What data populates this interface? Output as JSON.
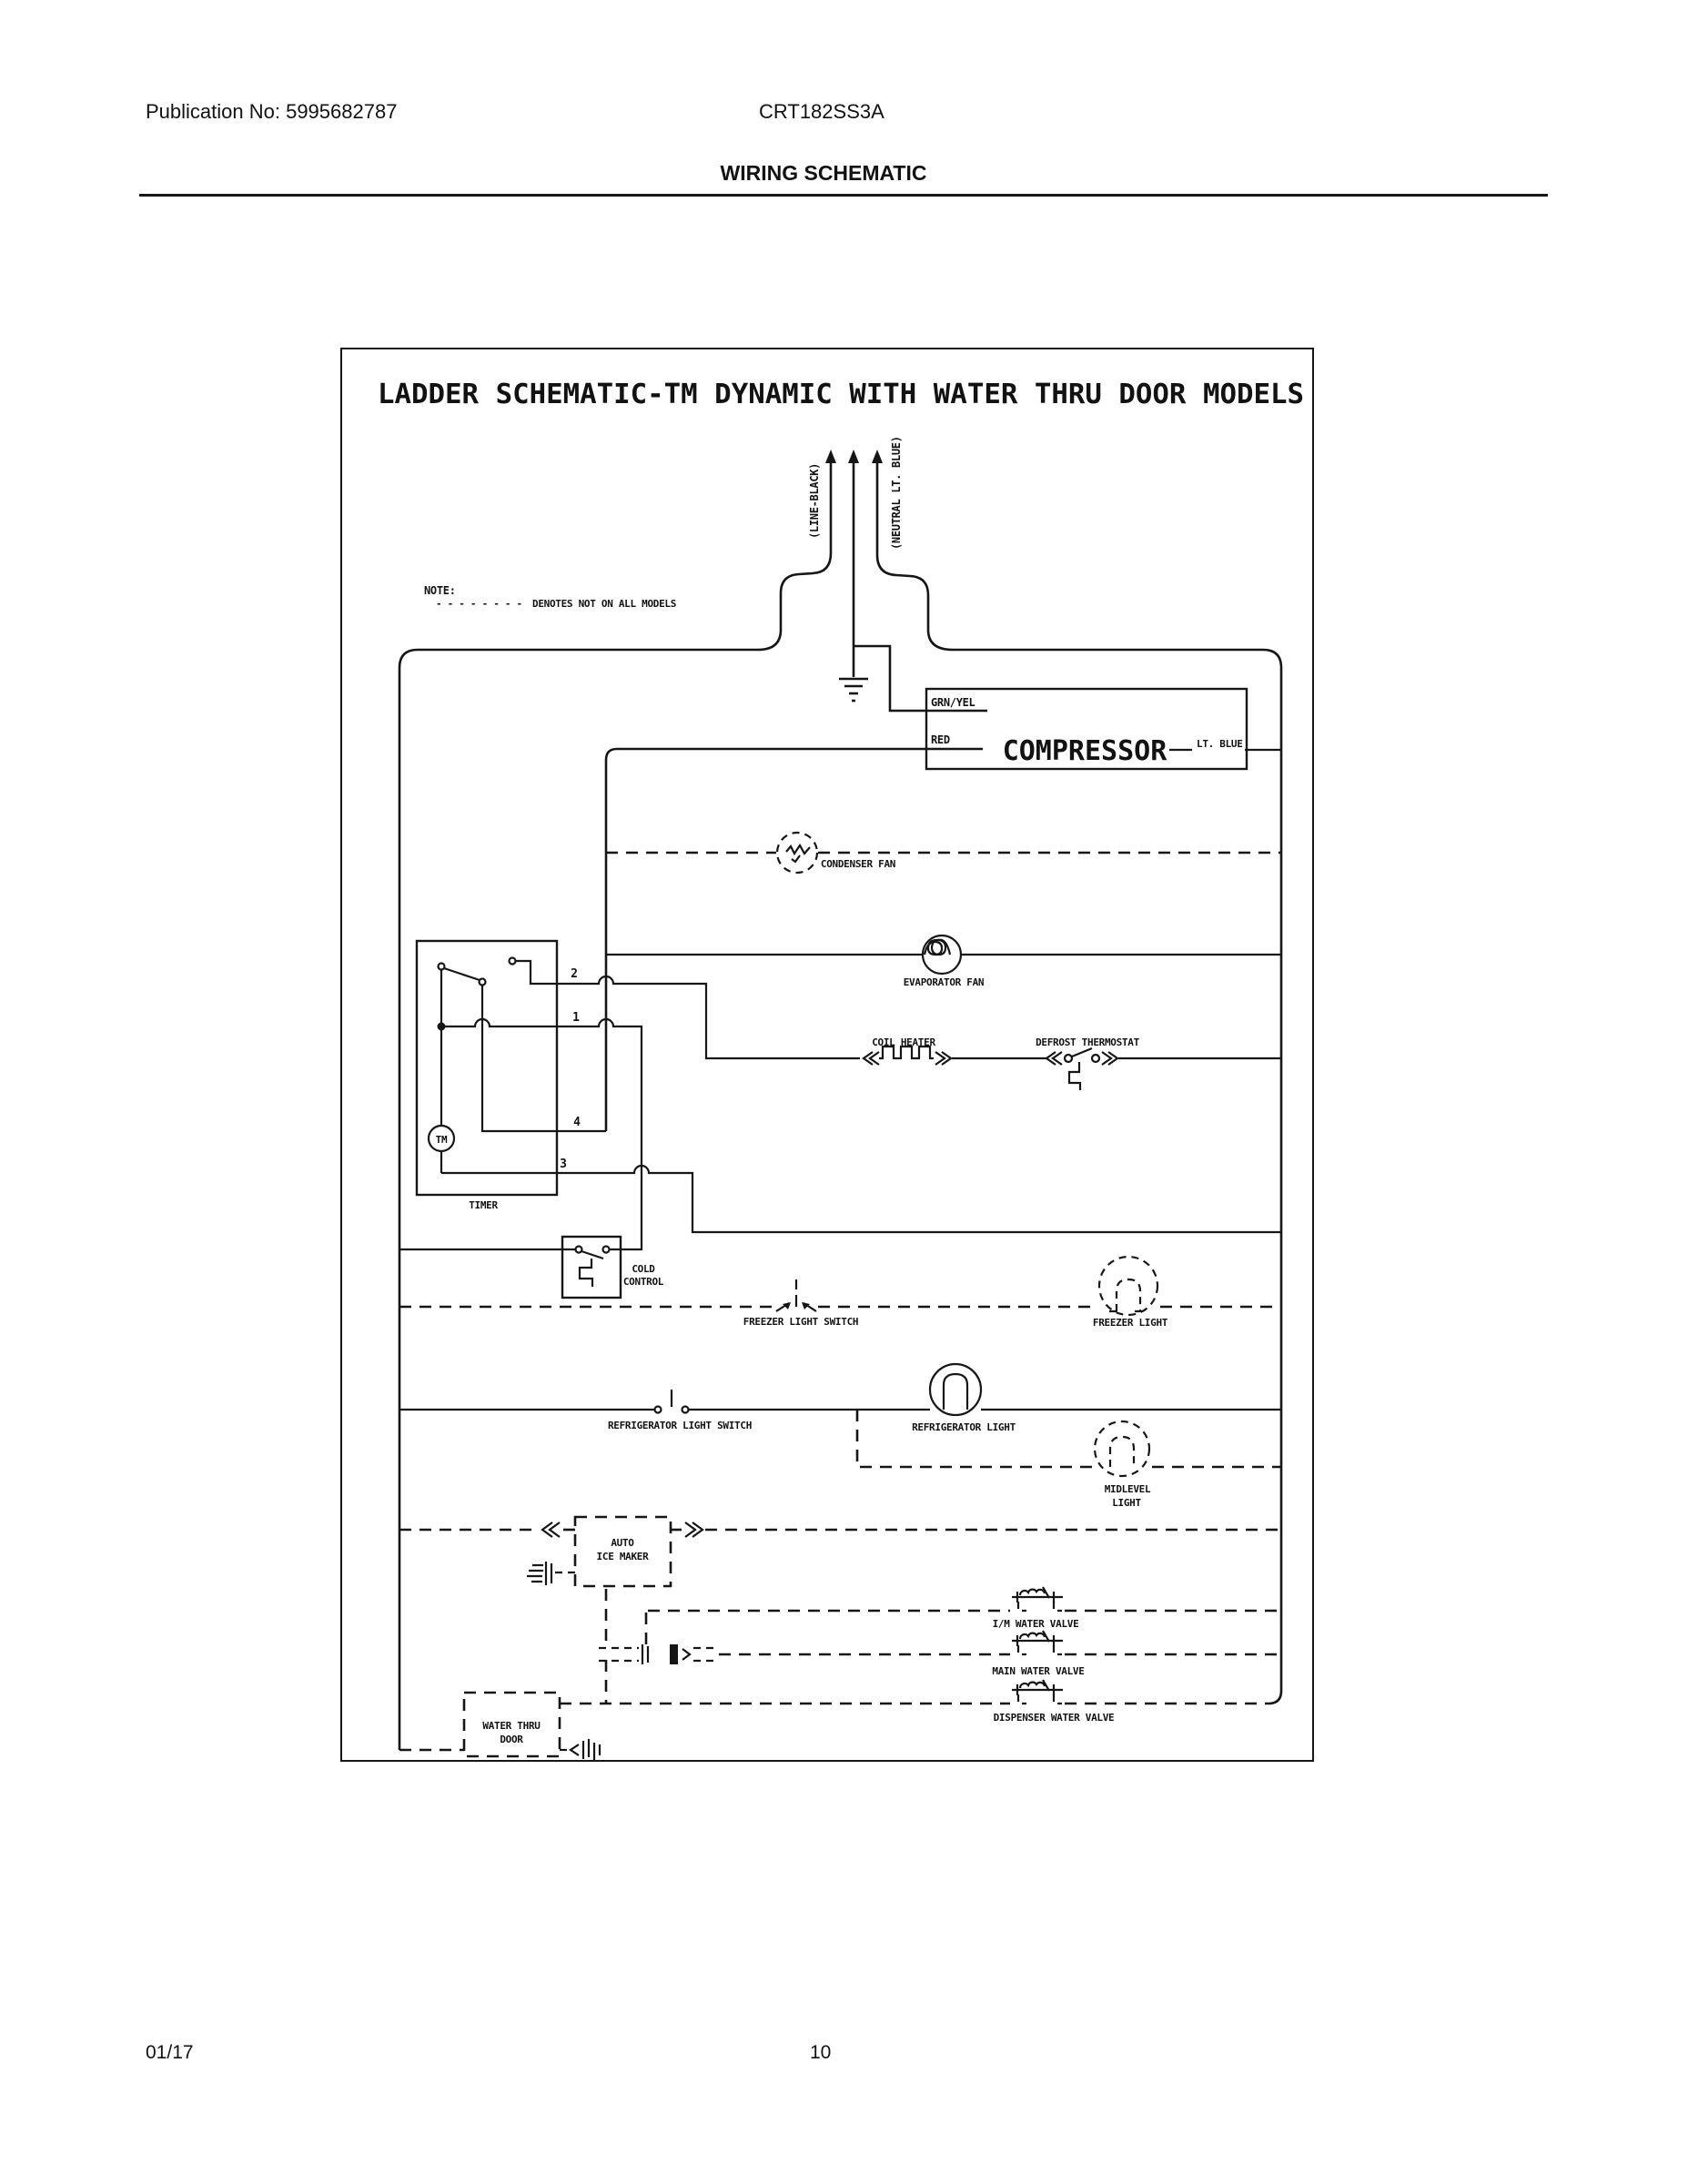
{
  "header": {
    "publication": "Publication No: 5995682787",
    "model": "CRT182SS3A",
    "title": "WIRING SCHEMATIC"
  },
  "footer": {
    "date": "01/17",
    "page": "10"
  },
  "schematic": {
    "title": "LADDER SCHEMATIC-TM DYNAMIC WITH WATER THRU DOOR MODELS",
    "note_label": "NOTE:",
    "note_dashes": "- - - - - - - -",
    "note_text": "DENOTES NOT ON ALL MODELS",
    "wire_labels": {
      "line": "(LINE-BLACK)",
      "neutral": "(NEUTRAL LT. BLUE)"
    },
    "compressor": {
      "label": "COMPRESSOR",
      "grn_yel": "GRN/YEL",
      "red": "RED",
      "lt_blue": "LT. BLUE"
    },
    "components": {
      "condenser_fan": "CONDENSER FAN",
      "evaporator_fan": "EVAPORATOR FAN",
      "coil_heater": "COIL HEATER",
      "defrost_thermostat": "DEFROST THERMOSTAT",
      "timer": "TIMER",
      "timer_motor": "TM",
      "terminal_1": "1",
      "terminal_2": "2",
      "terminal_3": "3",
      "terminal_4": "4",
      "cold_control_line1": "COLD",
      "cold_control_line2": "CONTROL",
      "freezer_light_switch": "FREEZER LIGHT SWITCH",
      "freezer_light": "FREEZER LIGHT",
      "refrigerator_light_switch": "REFRIGERATOR LIGHT SWITCH",
      "refrigerator_light": "REFRIGERATOR LIGHT",
      "midlevel_light_line1": "MIDLEVEL",
      "midlevel_light_line2": "LIGHT",
      "ice_maker_line1": "AUTO",
      "ice_maker_line2": "ICE MAKER",
      "im_water_valve": "I/M WATER VALVE",
      "main_water_valve": "MAIN WATER VALVE",
      "dispenser_water_valve": "DISPENSER WATER VALVE",
      "water_thru_door_line1": "WATER THRU",
      "water_thru_door_line2": "DOOR"
    }
  }
}
